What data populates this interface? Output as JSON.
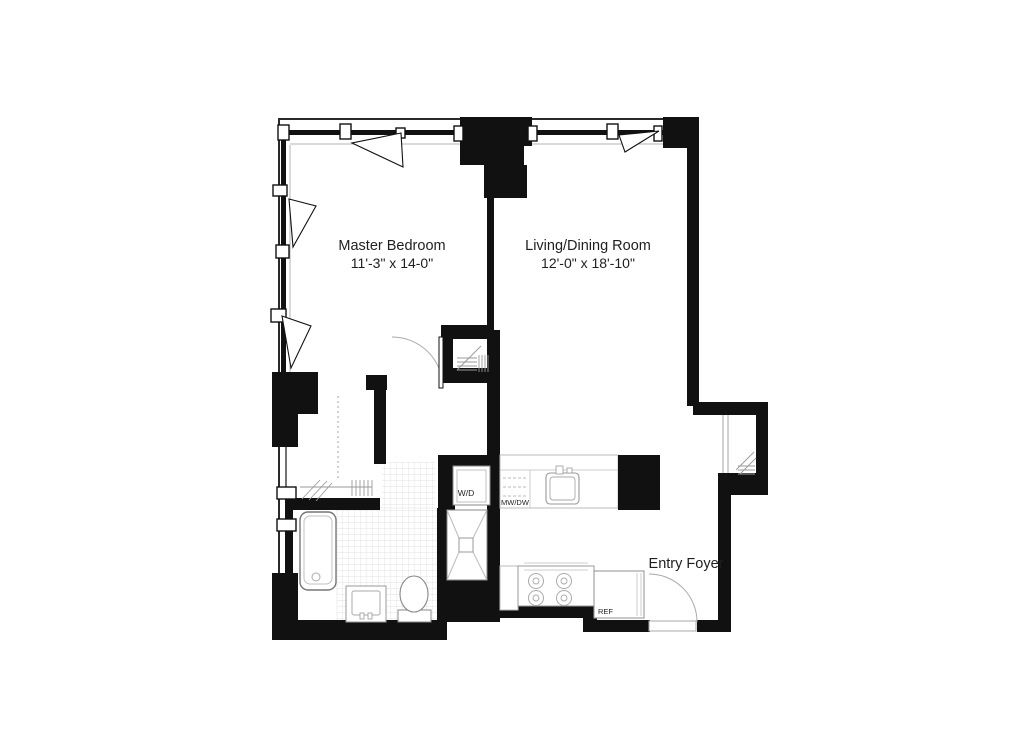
{
  "plan": {
    "type": "apartment-floor-plan",
    "rooms": {
      "master_bedroom": {
        "name": "Master Bedroom",
        "dimensions": "11'-3\" x 14-0\""
      },
      "living_dining": {
        "name": "Living/Dining Room",
        "dimensions": "12'-0\" x 18'-10\""
      },
      "entry_foyer": {
        "name": "Entry Foyer"
      }
    },
    "labels": {
      "washer_dryer": "W/D",
      "microwave_dishwasher": "MW/DW",
      "refrigerator": "REF"
    },
    "fixtures": [
      "bathtub",
      "vanity-sink",
      "toilet",
      "shower",
      "kitchen-sink",
      "stove",
      "refrigerator",
      "kitchen-counter",
      "walk-in-closet",
      "bedroom-closet",
      "entry-closet",
      "washer-dryer-closet"
    ],
    "colors": {
      "wall": "#111111",
      "fixture_line": "#999999",
      "tile_line": "#d9d9d9",
      "text": "#1f1f1f",
      "background": "#ffffff"
    }
  }
}
